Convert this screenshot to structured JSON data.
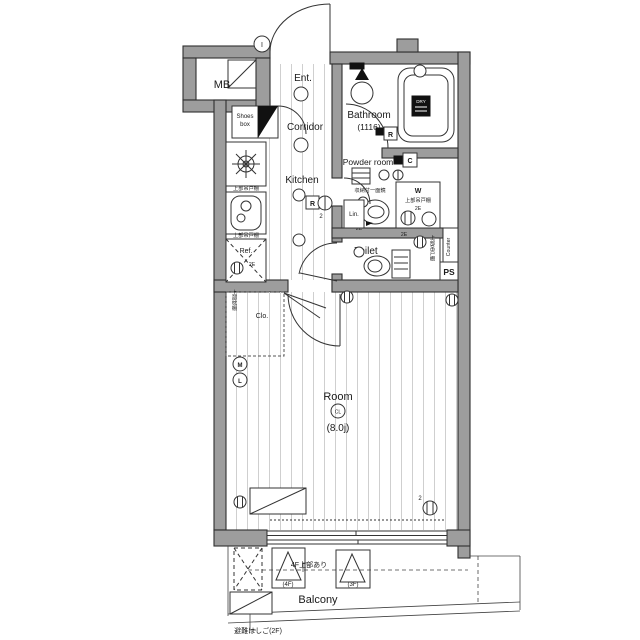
{
  "title": "apartment-floor-plan",
  "colors": {
    "wall": "#9d9d9d",
    "wall_stroke": "#2f2f2f",
    "line": "#333333",
    "floor_line": "#cfcfcf",
    "badge_black": "#111111",
    "background": "#ffffff"
  },
  "rooms": {
    "mb": "MB",
    "ent": "Ent.",
    "corridor": "Corridor",
    "kitchen": "Kitchen",
    "bathroom": "Bathroom",
    "bathroom_size": "(1116)",
    "powder_room": "Powder room",
    "toilet": "Toilet",
    "lin": "Lin.",
    "ref": "Ref.",
    "clo": "Clo.",
    "room": "Room",
    "room_size": "(8.0j)",
    "balcony": "Balcony",
    "shoes_line1": "Shoes",
    "shoes_line2": "box",
    "ps": "PS",
    "counter": "Counter",
    "washer": "W"
  },
  "badges": {
    "dry": "DRY",
    "remote_r": "R",
    "control_c": "C",
    "ceiling_light": "CL",
    "meter_m": "M",
    "meter_l": "L",
    "intercom_i": "I"
  },
  "annotations": {
    "hanging_cabinet": "上部吊戸棚",
    "closet_shelf": "上部枕棚",
    "mirror_cabinet": "収納付一面鏡",
    "floor4_above": "4F上部あり",
    "escape_ladder": "避難はしご(2F)",
    "floor4": "(4F)",
    "floor3": "(3F)",
    "outlet_2e": "2E",
    "outlet_2": "2",
    "burners_2": "2"
  }
}
